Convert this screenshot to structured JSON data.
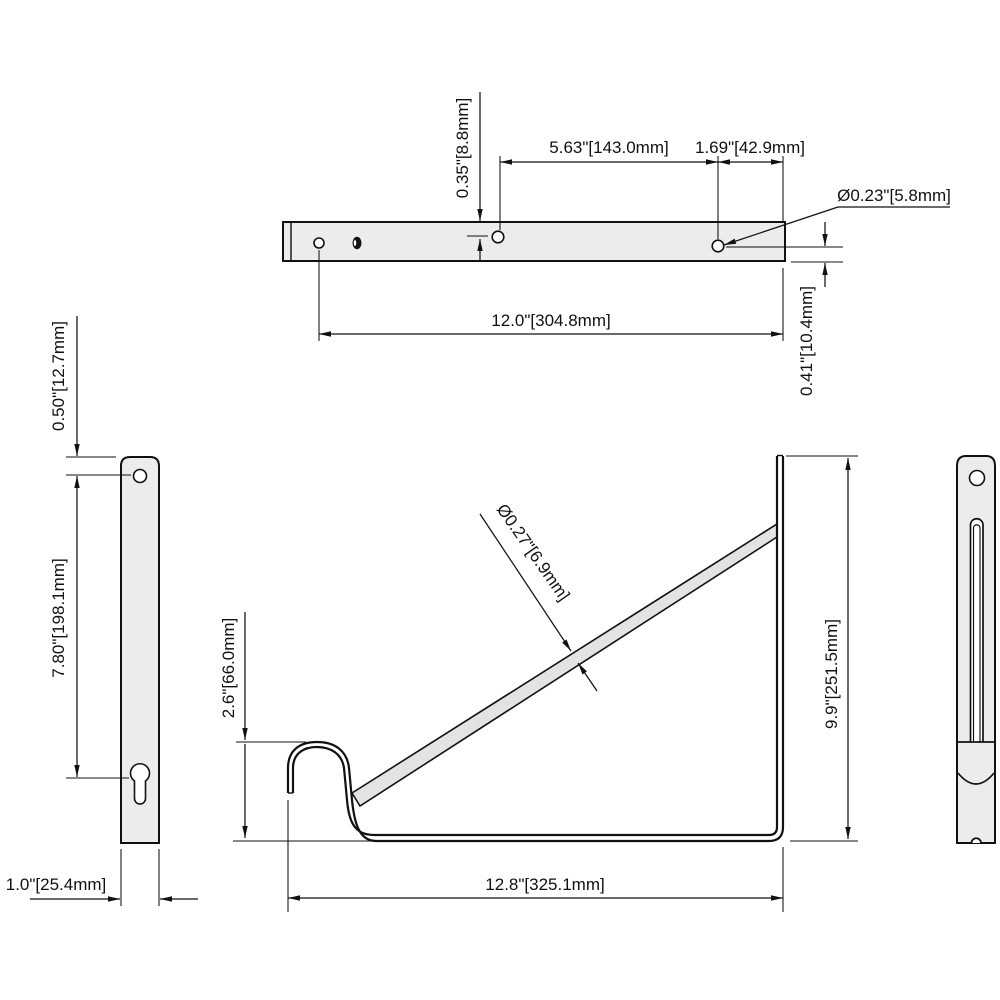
{
  "drawing": {
    "type": "technical-drawing",
    "subject": "heavy-duty shelf bracket, multi-view dimensioned drawing",
    "colors": {
      "background": "#ffffff",
      "line": "#111111",
      "part_fill": "#ececec",
      "strut_fill": "#e3e3e3",
      "dark_hole": "#141414"
    },
    "views": {
      "top": {
        "dims": {
          "hole_offset_top": "0.35\"[8.8mm]",
          "hole_spacing": "5.63\"[143.0mm]",
          "hole_to_end": "1.69\"[42.9mm]",
          "hole_diameter": "Ø0.23\"[5.8mm]",
          "overall_length": "12.0\"[304.8mm]",
          "hole_offset_bottom": "0.41\"[10.4mm]"
        }
      },
      "side_left": {
        "dims": {
          "top_hole_offset": "0.50\"[12.7mm]",
          "hole_to_keyhole": "7.80\"[198.1mm]",
          "bar_width": "1.0\"[25.4mm]"
        }
      },
      "front": {
        "dims": {
          "strut_diameter": "Ø0.27\"[6.9mm]",
          "hook_height": "2.6\"[66.0mm]",
          "overall_height": "9.9\"[251.5mm]",
          "overall_depth": "12.8\"[325.1mm]"
        }
      }
    }
  }
}
